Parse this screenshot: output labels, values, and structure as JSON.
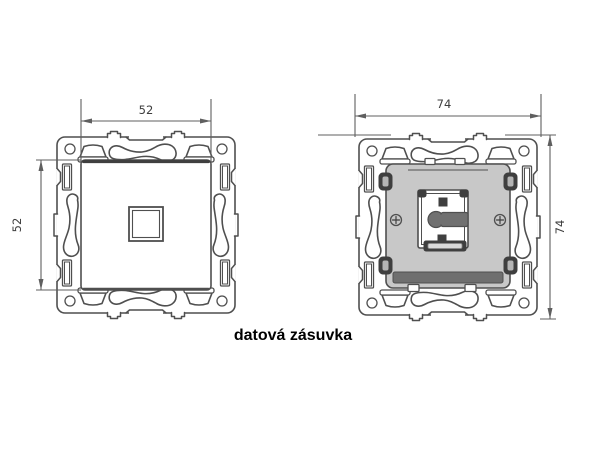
{
  "caption": "datová zásuvka",
  "left_figure": {
    "width_dim": "52",
    "height_dim": "52"
  },
  "right_figure": {
    "width_dim": "74",
    "height_dim": "74"
  },
  "colors": {
    "line": "#4f4f4f",
    "dim": "#5f5f5f",
    "dimtext": "#3d3d3d",
    "mech": "#c8c8c8",
    "dark": "#3f3f3f",
    "key": "#707070",
    "band": "#6f6f6f",
    "caption": "#000000"
  }
}
